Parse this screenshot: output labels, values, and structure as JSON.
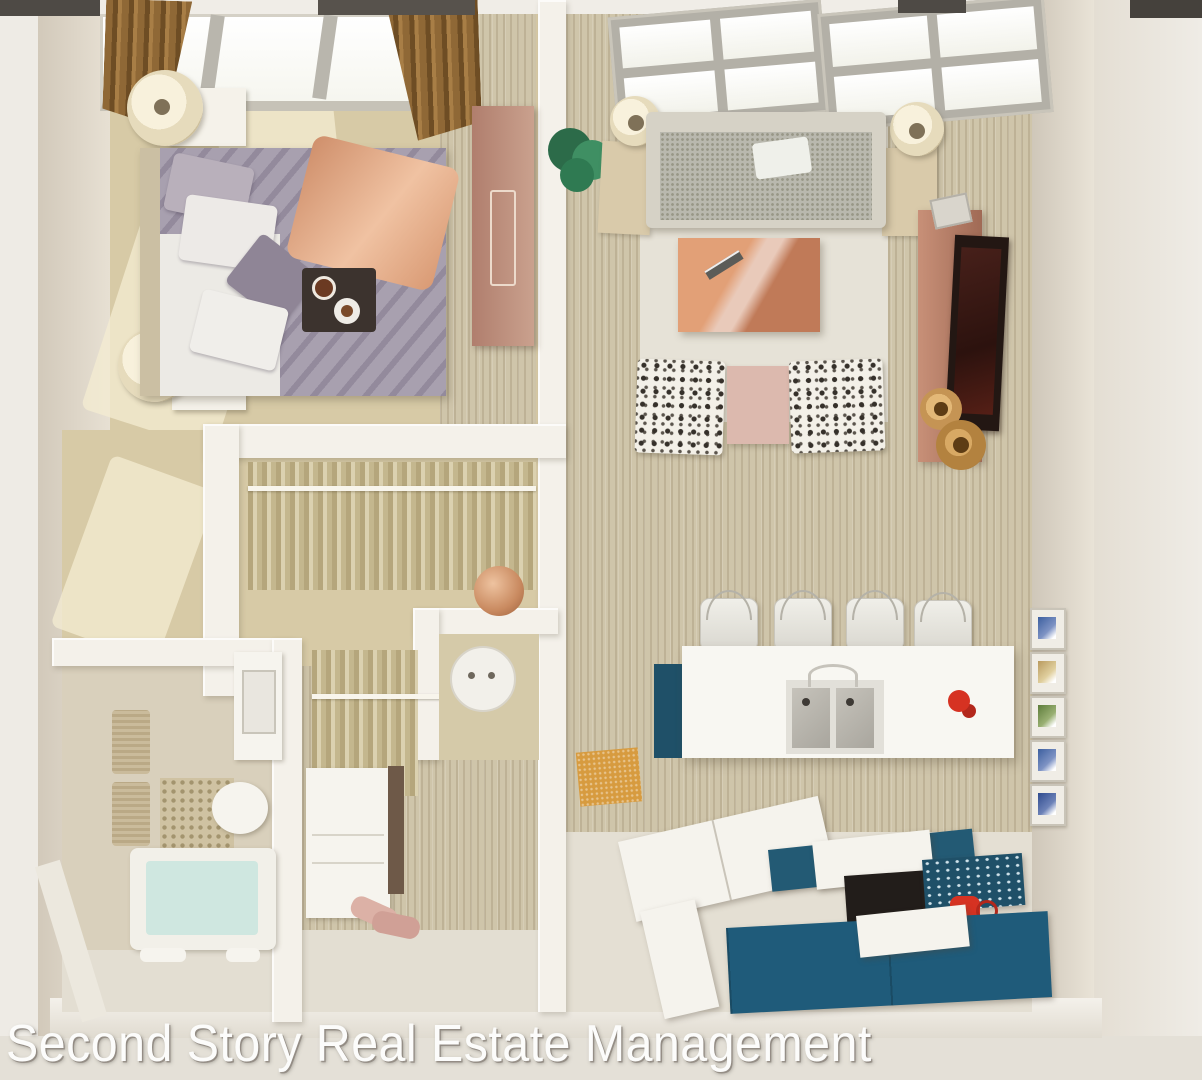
{
  "watermark": {
    "text": "Second Story Real Estate Management"
  },
  "scene": {
    "type": "3d-floor-plan-top-down-render",
    "rooms": [
      "bedroom",
      "walk-in-closet",
      "bathroom",
      "vanity-nook",
      "living-room",
      "kitchen",
      "entry-hall"
    ],
    "objects": {
      "bedroom": [
        "skylight-window",
        "brown-curtains",
        "double-bed",
        "gray-duvet",
        "copper-throw-blanket",
        "pillows",
        "breakfast-tray",
        "two-nightstands",
        "two-round-lamps",
        "wardrobe"
      ],
      "living_room": [
        "skylight-windows",
        "gray-fabric-sofa",
        "white-pillow",
        "copper-coffee-table",
        "two-patterned-armchairs",
        "pink-ottoman",
        "tv-console",
        "flat-tv",
        "floor-lamps",
        "green-plant",
        "wooden-vases"
      ],
      "walk_in_closet": [
        "hanging-rods",
        "hanging-clothes",
        "washer",
        "copper-decor-ball"
      ],
      "bathroom": [
        "bathtub",
        "toilet",
        "vanity-sink-with-mirror",
        "towel-rack",
        "mosaic-tiles"
      ],
      "vanity_nook": [
        "white-drawer-cabinet",
        "pink-towels"
      ],
      "kitchen": [
        "island-counter",
        "four-bar-stools",
        "double-sink",
        "faucet",
        "red-mixer",
        "wall-tile-art",
        "orange-floor-mat",
        "l-shaped-counter",
        "teal-base-cabinets",
        "black-stove",
        "red-kettle"
      ]
    },
    "palette": {
      "outside": "#e9e6e0",
      "wall_white": "#f4f1ea",
      "floor_tan": "#d7caa6",
      "wood": "#cfc5aa",
      "duvet": "#9e95a6",
      "copper": "#cf8f6b",
      "curtain_brown": "#8a6134",
      "teal_cabinet": "#1f5068",
      "aqua": "#cfe7e0",
      "accent_red": "#d63222"
    }
  }
}
